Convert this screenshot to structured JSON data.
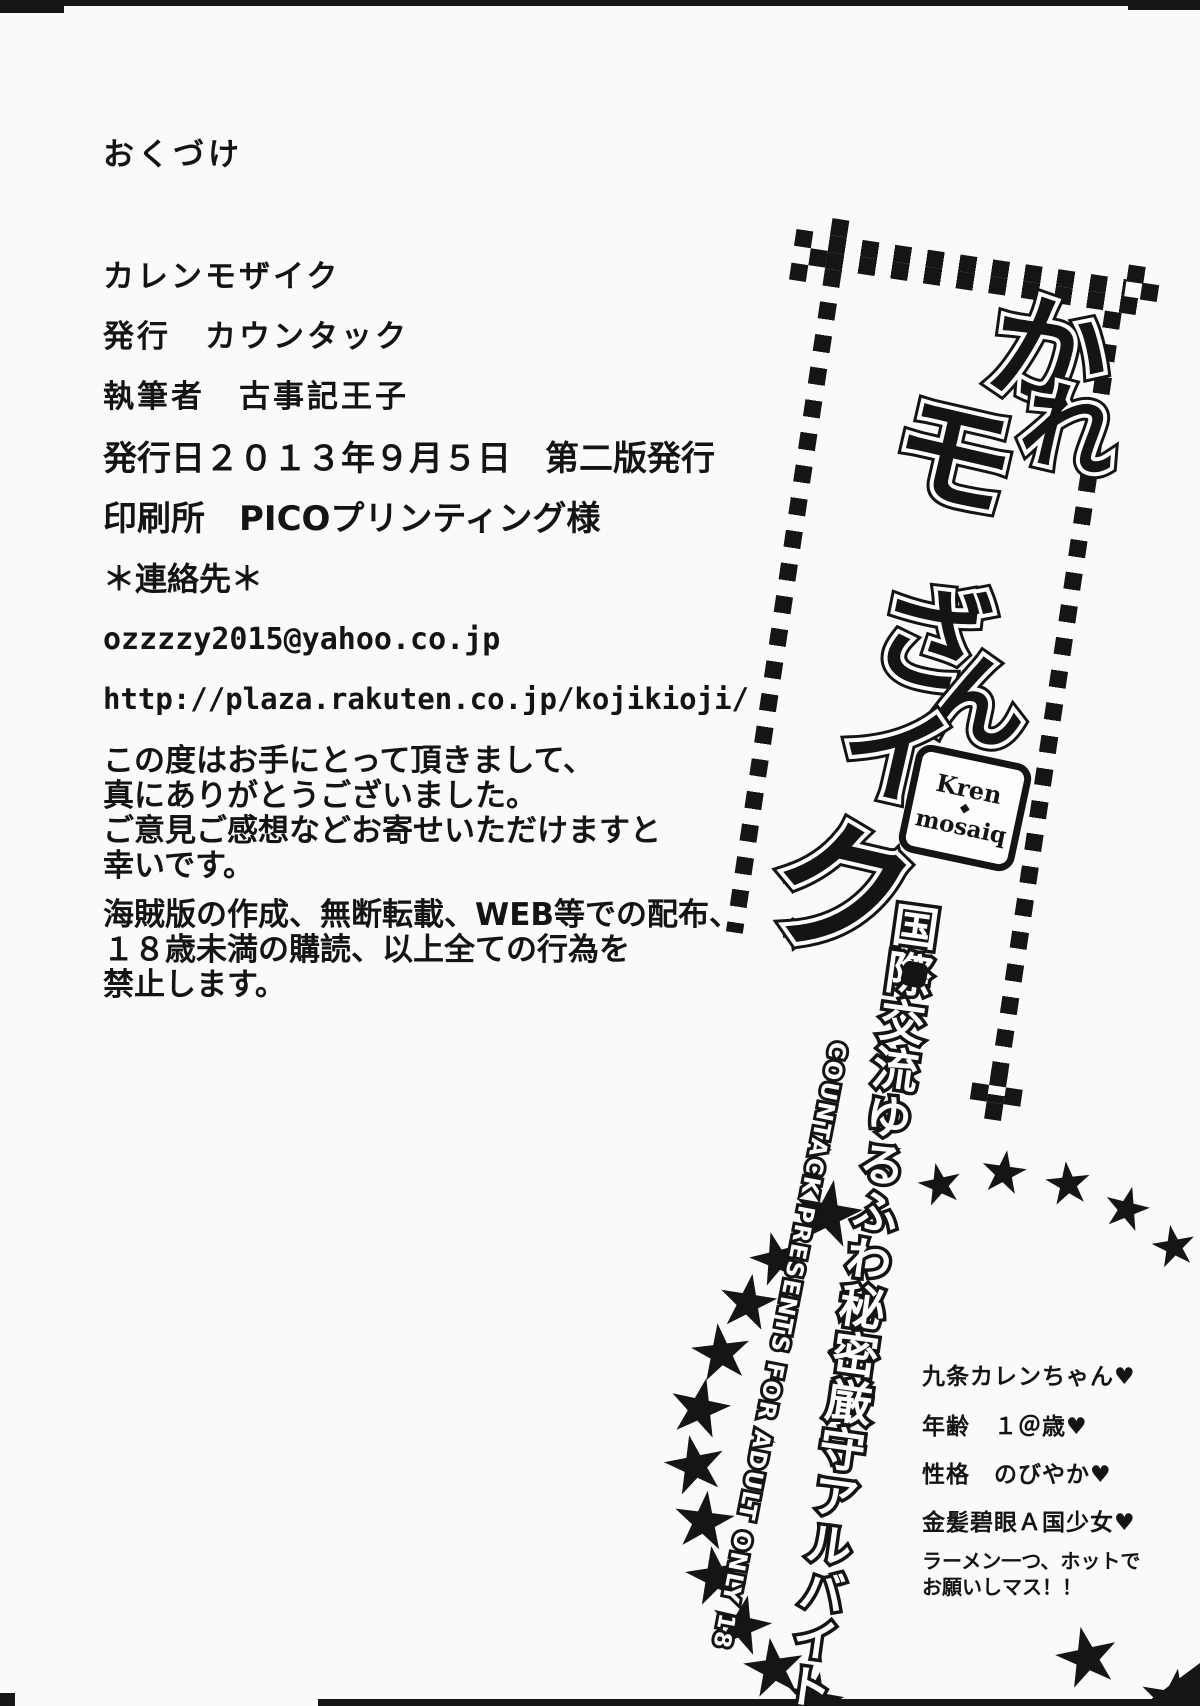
{
  "page": {
    "section_label": "おくづけ"
  },
  "colophon": {
    "lines": [
      "カレンモザイク",
      "発行　カウンタック",
      "執筆者　古事記王子",
      "発行日２０１３年９月５日　第二版発行",
      "印刷所　PICOプリンティング様",
      "＊連絡先＊",
      "ozzzzy2015@yahoo.co.jp",
      "http://plaza.rakuten.co.jp/kojikioji/"
    ],
    "thanks_lines": [
      "この度はお手にとって頂きまして、",
      "真にありがとうございました。",
      "ご意見ご感想などお寄せいただけますと",
      "幸いです。"
    ],
    "notice_lines": [
      "海賊版の作成、無断転載、WEB等での配布、",
      "１８歳未満の購読、以上全ての行為を",
      "禁止します。"
    ]
  },
  "logo": {
    "glyphs": [
      "か",
      "モ",
      "れ",
      "ざ",
      "ん",
      "イ",
      "ク"
    ],
    "badge": {
      "top": "Kren",
      "diamond": "◆",
      "bottom": "mosaiq"
    },
    "subtitle": "国際交流ゆるふわ秘密厳守アルバイト♡",
    "credit": "COUNTACK PRESENTS FOR ADULT ONLY 18"
  },
  "profile": {
    "name": "九条カレンちゃん♥",
    "age": "年齢　１＠歳♥",
    "personality": "性格　のびやか♥",
    "trait": "金髪碧眼Ａ国少女♥",
    "request_lines": [
      "ラーメン一つ、ホットで",
      "お願いしマス！！"
    ]
  },
  "icons": {
    "star": "★"
  },
  "colors": {
    "ink": "#141414",
    "paper": "#fafaf8"
  }
}
